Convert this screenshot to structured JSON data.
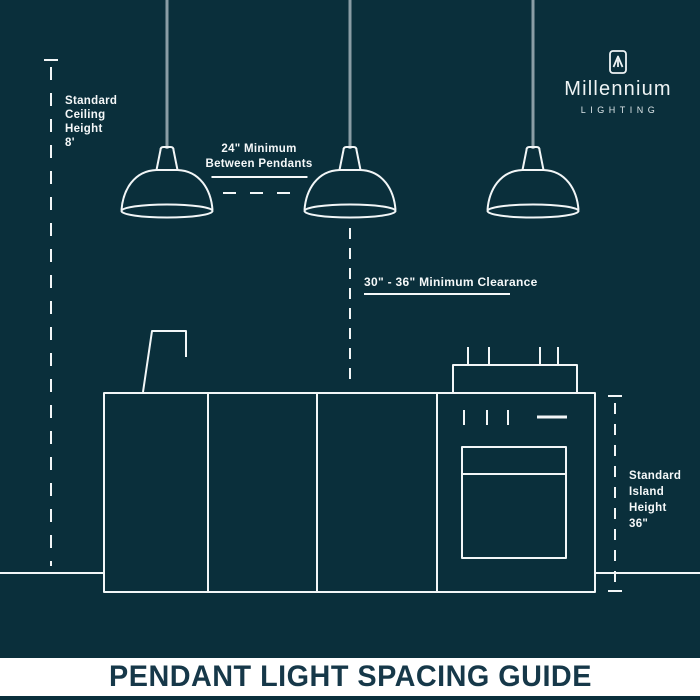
{
  "colors": {
    "background": "#0a2f3b",
    "line": "#f2f6f7",
    "cord": "#8a9da5",
    "footer_background": "#ffffff",
    "footer_text": "#163849"
  },
  "brand": {
    "name": "Millennium",
    "subtitle": "LIGHTING"
  },
  "annotations": {
    "ceiling_height": {
      "lines": [
        "Standard",
        "Ceiling",
        "Height",
        "8'"
      ]
    },
    "pendant_spacing": {
      "lines": [
        "24\" Minimum",
        "Between Pendants"
      ]
    },
    "clearance": {
      "text": "30\" - 36\" Minimum Clearance"
    },
    "island_height": {
      "lines": [
        "Standard",
        "Island",
        "Height",
        "36\""
      ]
    }
  },
  "diagram": {
    "pendant_count": 3
  },
  "footer": {
    "title": "PENDANT LIGHT SPACING GUIDE"
  }
}
